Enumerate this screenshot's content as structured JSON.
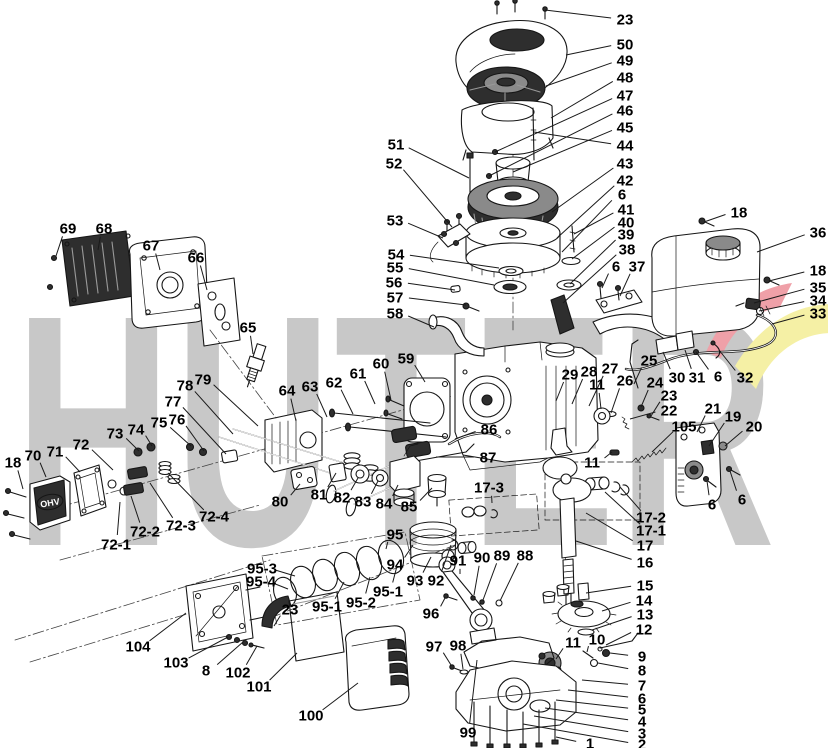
{
  "watermark": {
    "text": "HUTER",
    "letter_color": "#c8c8c8",
    "swoosh_red": "#efa0a8",
    "swoosh_yellow": "#f5f0a5"
  },
  "drawing_labels": {
    "valve_cover_text": "OHV"
  },
  "callout_style": {
    "color": "#000000",
    "line_color": "#1a1a1a"
  },
  "callouts": [
    {
      "label": "23",
      "x": 625,
      "y": 19,
      "tx": 545,
      "ty": 10
    },
    {
      "label": "50",
      "x": 625,
      "y": 44,
      "tx": 566,
      "ty": 55
    },
    {
      "label": "49",
      "x": 625,
      "y": 60,
      "tx": 546,
      "ty": 86
    },
    {
      "label": "48",
      "x": 625,
      "y": 77,
      "tx": 551,
      "ty": 118
    },
    {
      "label": "47",
      "x": 625,
      "y": 95,
      "tx": 495,
      "ty": 152
    },
    {
      "label": "46",
      "x": 625,
      "y": 110,
      "tx": 489,
      "ty": 176
    },
    {
      "label": "45",
      "x": 625,
      "y": 127,
      "tx": 513,
      "ty": 172
    },
    {
      "label": "44",
      "x": 625,
      "y": 145,
      "tx": 534,
      "ty": 132
    },
    {
      "label": "43",
      "x": 625,
      "y": 163,
      "tx": 552,
      "ty": 212
    },
    {
      "label": "42",
      "x": 625,
      "y": 180,
      "tx": 557,
      "ty": 238
    },
    {
      "label": "6",
      "x": 622,
      "y": 194,
      "tx": 562,
      "ty": 252
    },
    {
      "label": "41",
      "x": 626,
      "y": 209,
      "tx": 574,
      "ty": 234
    },
    {
      "label": "40",
      "x": 626,
      "y": 222,
      "tx": 572,
      "ty": 259
    },
    {
      "label": "39",
      "x": 626,
      "y": 234,
      "tx": 570,
      "ty": 284
    },
    {
      "label": "38",
      "x": 627,
      "y": 249,
      "tx": 563,
      "ty": 303
    },
    {
      "label": "6",
      "x": 616,
      "y": 266,
      "tx": 602,
      "ty": 288
    },
    {
      "label": "37",
      "x": 637,
      "y": 266,
      "tx": 620,
      "ty": 296
    },
    {
      "label": "18",
      "x": 739,
      "y": 212,
      "tx": 704,
      "ty": 222
    },
    {
      "label": "36",
      "x": 818,
      "y": 232,
      "tx": 757,
      "ty": 252
    },
    {
      "label": "18",
      "x": 818,
      "y": 270,
      "tx": 769,
      "ty": 281
    },
    {
      "label": "35",
      "x": 818,
      "y": 287,
      "tx": 754,
      "ty": 303
    },
    {
      "label": "34",
      "x": 818,
      "y": 300,
      "tx": 759,
      "ty": 311
    },
    {
      "label": "33",
      "x": 818,
      "y": 313,
      "tx": 772,
      "ty": 324
    },
    {
      "label": "25",
      "x": 649,
      "y": 360,
      "tx": 634,
      "ty": 384
    },
    {
      "label": "30",
      "x": 677,
      "y": 377,
      "tx": 663,
      "ty": 352
    },
    {
      "label": "31",
      "x": 697,
      "y": 377,
      "tx": 685,
      "ty": 350
    },
    {
      "label": "6",
      "x": 718,
      "y": 376,
      "tx": 696,
      "ty": 352
    },
    {
      "label": "32",
      "x": 745,
      "y": 377,
      "tx": 719,
      "ty": 350
    },
    {
      "label": "29",
      "x": 570,
      "y": 374,
      "tx": 556,
      "ty": 401
    },
    {
      "label": "28",
      "x": 589,
      "y": 371,
      "tx": 572,
      "ty": 404
    },
    {
      "label": "27",
      "x": 610,
      "y": 368,
      "tx": 589,
      "ty": 406
    },
    {
      "label": "11",
      "x": 597,
      "y": 384,
      "tx": 601,
      "ty": 409
    },
    {
      "label": "26",
      "x": 625,
      "y": 380,
      "tx": 611,
      "ty": 413
    },
    {
      "label": "24",
      "x": 655,
      "y": 382,
      "tx": 641,
      "ty": 407
    },
    {
      "label": "23",
      "x": 669,
      "y": 395,
      "tx": 651,
      "ty": 416
    },
    {
      "label": "22",
      "x": 669,
      "y": 410,
      "tx": 630,
      "ty": 419
    },
    {
      "label": "105",
      "x": 684,
      "y": 426,
      "tx": 652,
      "ty": 452
    },
    {
      "label": "21",
      "x": 713,
      "y": 408,
      "tx": 697,
      "ty": 432
    },
    {
      "label": "19",
      "x": 733,
      "y": 416,
      "tx": 709,
      "ty": 446
    },
    {
      "label": "20",
      "x": 754,
      "y": 426,
      "tx": 725,
      "ty": 446
    },
    {
      "label": "6",
      "x": 712,
      "y": 504,
      "tx": 707,
      "ty": 481
    },
    {
      "label": "6",
      "x": 742,
      "y": 499,
      "tx": 730,
      "ty": 471
    },
    {
      "label": "11",
      "x": 592,
      "y": 462,
      "tx": 612,
      "ty": 452
    },
    {
      "label": "17-2",
      "x": 651,
      "y": 517,
      "tx": 620,
      "ty": 487
    },
    {
      "label": "17-1",
      "x": 651,
      "y": 530,
      "tx": 605,
      "ty": 492
    },
    {
      "label": "17",
      "x": 645,
      "y": 545,
      "tx": 586,
      "ty": 513
    },
    {
      "label": "16",
      "x": 645,
      "y": 562,
      "tx": 576,
      "ty": 541
    },
    {
      "label": "15",
      "x": 645,
      "y": 585,
      "tx": 586,
      "ty": 593
    },
    {
      "label": "14",
      "x": 644,
      "y": 600,
      "tx": 602,
      "ty": 611
    },
    {
      "label": "13",
      "x": 645,
      "y": 614,
      "tx": 592,
      "ty": 630
    },
    {
      "label": "12",
      "x": 644,
      "y": 629,
      "tx": 606,
      "ty": 645
    },
    {
      "label": "11",
      "x": 573,
      "y": 642,
      "tx": 556,
      "ty": 659
    },
    {
      "label": "10",
      "x": 597,
      "y": 639,
      "tx": 587,
      "ty": 652
    },
    {
      "label": "9",
      "x": 642,
      "y": 656,
      "tx": 610,
      "ty": 653
    },
    {
      "label": "8",
      "x": 642,
      "y": 670,
      "tx": 598,
      "ty": 663
    },
    {
      "label": "7",
      "x": 642,
      "y": 685,
      "tx": 582,
      "ty": 680
    },
    {
      "label": "6",
      "x": 642,
      "y": 698,
      "tx": 568,
      "ty": 690
    },
    {
      "label": "5",
      "x": 642,
      "y": 709,
      "tx": 556,
      "ty": 700
    },
    {
      "label": "4",
      "x": 642,
      "y": 721,
      "tx": 545,
      "ty": 708
    },
    {
      "label": "3",
      "x": 642,
      "y": 733,
      "tx": 534,
      "ty": 716
    },
    {
      "label": "2",
      "x": 642,
      "y": 744,
      "tx": 523,
      "ty": 724
    },
    {
      "label": "1",
      "x": 590,
      "y": 743,
      "tx": 556,
      "ty": 737
    },
    {
      "label": "69",
      "x": 68,
      "y": 228,
      "tx": 56,
      "ty": 256
    },
    {
      "label": "68",
      "x": 104,
      "y": 228,
      "tx": 98,
      "ty": 250
    },
    {
      "label": "67",
      "x": 151,
      "y": 245,
      "tx": 160,
      "ty": 270
    },
    {
      "label": "66",
      "x": 196,
      "y": 257,
      "tx": 207,
      "ty": 290
    },
    {
      "label": "65",
      "x": 248,
      "y": 327,
      "tx": 253,
      "ty": 354
    },
    {
      "label": "51",
      "x": 396,
      "y": 144,
      "tx": 469,
      "ty": 178
    },
    {
      "label": "52",
      "x": 394,
      "y": 163,
      "tx": 452,
      "ty": 227
    },
    {
      "label": "53",
      "x": 395,
      "y": 220,
      "tx": 443,
      "ty": 238
    },
    {
      "label": "54",
      "x": 396,
      "y": 254,
      "tx": 499,
      "ty": 268
    },
    {
      "label": "55",
      "x": 395,
      "y": 267,
      "tx": 494,
      "ty": 285
    },
    {
      "label": "56",
      "x": 394,
      "y": 282,
      "tx": 455,
      "ty": 290
    },
    {
      "label": "57",
      "x": 395,
      "y": 297,
      "tx": 466,
      "ty": 305
    },
    {
      "label": "58",
      "x": 395,
      "y": 313,
      "tx": 434,
      "ty": 327
    },
    {
      "label": "60",
      "x": 381,
      "y": 363,
      "tx": 391,
      "ty": 400
    },
    {
      "label": "59",
      "x": 406,
      "y": 358,
      "tx": 425,
      "ty": 382
    },
    {
      "label": "61",
      "x": 358,
      "y": 373,
      "tx": 375,
      "ty": 404
    },
    {
      "label": "62",
      "x": 334,
      "y": 382,
      "tx": 353,
      "ty": 414
    },
    {
      "label": "63",
      "x": 310,
      "y": 386,
      "tx": 327,
      "ty": 417
    },
    {
      "label": "64",
      "x": 287,
      "y": 390,
      "tx": 296,
      "ty": 421
    },
    {
      "label": "78",
      "x": 185,
      "y": 385,
      "tx": 233,
      "ty": 434
    },
    {
      "label": "79",
      "x": 203,
      "y": 379,
      "tx": 258,
      "ty": 426
    },
    {
      "label": "77",
      "x": 173,
      "y": 401,
      "tx": 226,
      "ty": 454
    },
    {
      "label": "75",
      "x": 159,
      "y": 422,
      "tx": 191,
      "ty": 446
    },
    {
      "label": "76",
      "x": 177,
      "y": 419,
      "tx": 204,
      "ty": 451
    },
    {
      "label": "74",
      "x": 136,
      "y": 429,
      "tx": 152,
      "ty": 446
    },
    {
      "label": "73",
      "x": 115,
      "y": 433,
      "tx": 139,
      "ty": 451
    },
    {
      "label": "72",
      "x": 81,
      "y": 444,
      "tx": 113,
      "ty": 470
    },
    {
      "label": "71",
      "x": 55,
      "y": 451,
      "tx": 80,
      "ty": 472
    },
    {
      "label": "70",
      "x": 33,
      "y": 455,
      "tx": 46,
      "ty": 477
    },
    {
      "label": "18",
      "x": 13,
      "y": 462,
      "tx": 23,
      "ty": 489
    },
    {
      "label": "72-1",
      "x": 116,
      "y": 544,
      "tx": 120,
      "ty": 502
    },
    {
      "label": "72-2",
      "x": 145,
      "y": 531,
      "tx": 131,
      "ty": 496
    },
    {
      "label": "72-3",
      "x": 181,
      "y": 525,
      "tx": 150,
      "ty": 483
    },
    {
      "label": "72-4",
      "x": 214,
      "y": 516,
      "tx": 168,
      "ty": 473
    },
    {
      "label": "86",
      "x": 489,
      "y": 429,
      "tx": 455,
      "ty": 439
    },
    {
      "label": "87",
      "x": 488,
      "y": 457,
      "tx": 436,
      "ty": 457
    },
    {
      "label": "17-3",
      "x": 489,
      "y": 487,
      "tx": 492,
      "ty": 503
    },
    {
      "label": "80",
      "x": 280,
      "y": 501,
      "tx": 300,
      "ty": 484
    },
    {
      "label": "81",
      "x": 319,
      "y": 494,
      "tx": 336,
      "ty": 473
    },
    {
      "label": "82",
      "x": 342,
      "y": 497,
      "tx": 358,
      "ty": 478
    },
    {
      "label": "83",
      "x": 363,
      "y": 501,
      "tx": 378,
      "ty": 481
    },
    {
      "label": "84",
      "x": 384,
      "y": 503,
      "tx": 398,
      "ty": 485
    },
    {
      "label": "85",
      "x": 409,
      "y": 506,
      "tx": 432,
      "ty": 488
    },
    {
      "label": "95",
      "x": 395,
      "y": 534,
      "tx": 386,
      "ty": 549
    },
    {
      "label": "94",
      "x": 395,
      "y": 564,
      "tx": 413,
      "ty": 545
    },
    {
      "label": "93",
      "x": 415,
      "y": 580,
      "tx": 431,
      "ty": 557
    },
    {
      "label": "92",
      "x": 436,
      "y": 580,
      "tx": 451,
      "ty": 545
    },
    {
      "label": "91",
      "x": 458,
      "y": 560,
      "tx": 460,
      "ty": 574
    },
    {
      "label": "90",
      "x": 482,
      "y": 557,
      "tx": 474,
      "ty": 595
    },
    {
      "label": "89",
      "x": 502,
      "y": 555,
      "tx": 483,
      "ty": 600
    },
    {
      "label": "88",
      "x": 525,
      "y": 555,
      "tx": 500,
      "ty": 601
    },
    {
      "label": "96",
      "x": 431,
      "y": 613,
      "tx": 445,
      "ty": 598
    },
    {
      "label": "97",
      "x": 434,
      "y": 646,
      "tx": 451,
      "ty": 665
    },
    {
      "label": "98",
      "x": 458,
      "y": 645,
      "tx": 463,
      "ty": 669
    },
    {
      "label": "99",
      "x": 468,
      "y": 732,
      "tx": 477,
      "ty": 660
    },
    {
      "label": "95-1",
      "x": 388,
      "y": 591,
      "tx": 397,
      "ty": 566
    },
    {
      "label": "95-2",
      "x": 361,
      "y": 602,
      "tx": 370,
      "ty": 577
    },
    {
      "label": "95-1",
      "x": 327,
      "y": 606,
      "tx": 344,
      "ty": 582
    },
    {
      "label": "95-3",
      "x": 262,
      "y": 568,
      "tx": 295,
      "ty": 576
    },
    {
      "label": "95-4",
      "x": 261,
      "y": 581,
      "tx": 288,
      "ty": 589
    },
    {
      "label": "23",
      "x": 290,
      "y": 609,
      "tx": 274,
      "ty": 626
    },
    {
      "label": "104",
      "x": 138,
      "y": 646,
      "tx": 186,
      "ty": 613
    },
    {
      "label": "103",
      "x": 176,
      "y": 662,
      "tx": 228,
      "ty": 637
    },
    {
      "label": "8",
      "x": 206,
      "y": 670,
      "tx": 243,
      "ty": 642
    },
    {
      "label": "102",
      "x": 238,
      "y": 672,
      "tx": 257,
      "ty": 646
    },
    {
      "label": "101",
      "x": 259,
      "y": 686,
      "tx": 297,
      "ty": 653
    },
    {
      "label": "100",
      "x": 311,
      "y": 715,
      "tx": 358,
      "ty": 683
    }
  ]
}
